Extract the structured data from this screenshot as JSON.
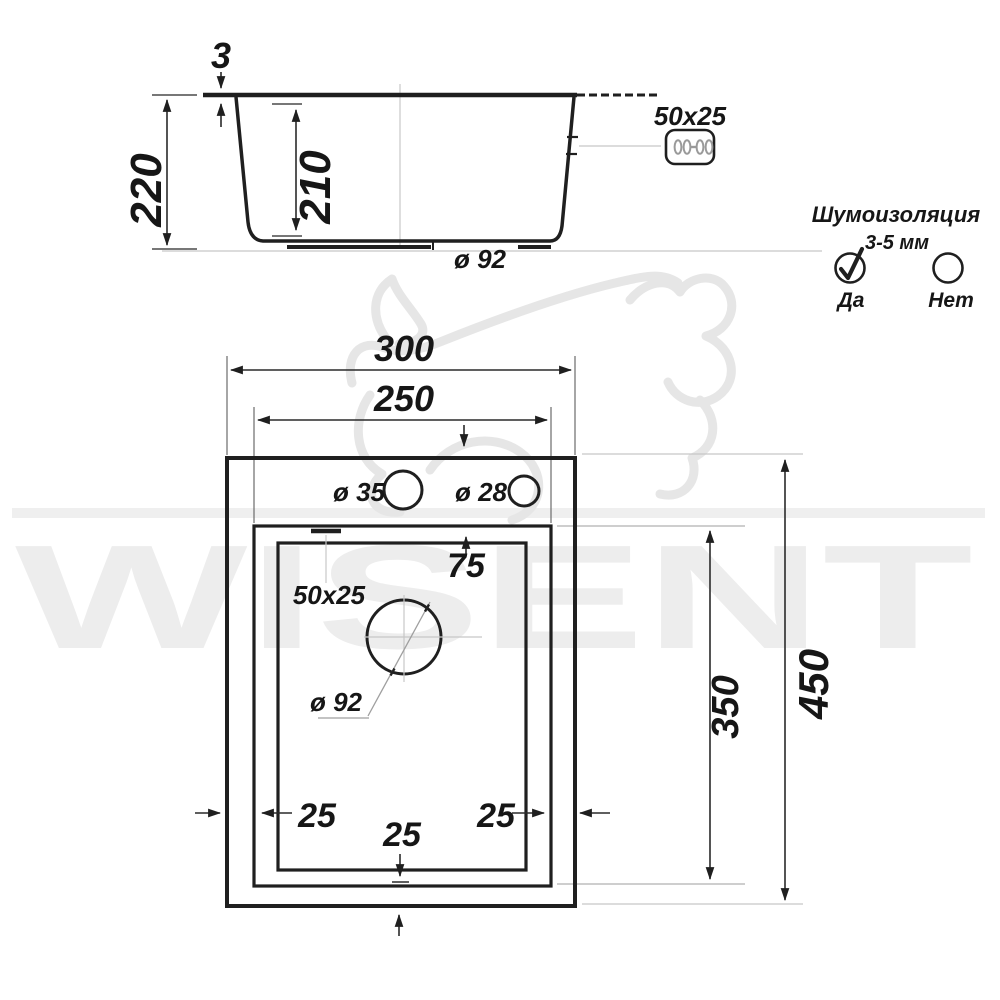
{
  "watermark": {
    "brand": "WISENT"
  },
  "colors": {
    "line": "#1f1f1f",
    "construction_gray": "#c7c7c7",
    "watermark_gray": "#ededed",
    "background": "#ffffff"
  },
  "side_view": {
    "rim_thickness": "3",
    "overall_height": "220",
    "bowl_depth": "210",
    "drain": "ø 92",
    "overflow": "50x25"
  },
  "top_view": {
    "overall_width": "300",
    "bowl_width": "250",
    "hole_large": "ø 35",
    "hole_small": "ø 28",
    "front_offset": "75",
    "overflow": "50x25",
    "drain": "ø 92",
    "offset_left": "25",
    "offset_bottom": "25",
    "offset_right": "25",
    "bowl_length": "350",
    "overall_length": "450"
  },
  "insulation": {
    "title": "Шумоизоляция",
    "thickness": "3-5 мм",
    "yes": "Да",
    "no": "Нет"
  }
}
